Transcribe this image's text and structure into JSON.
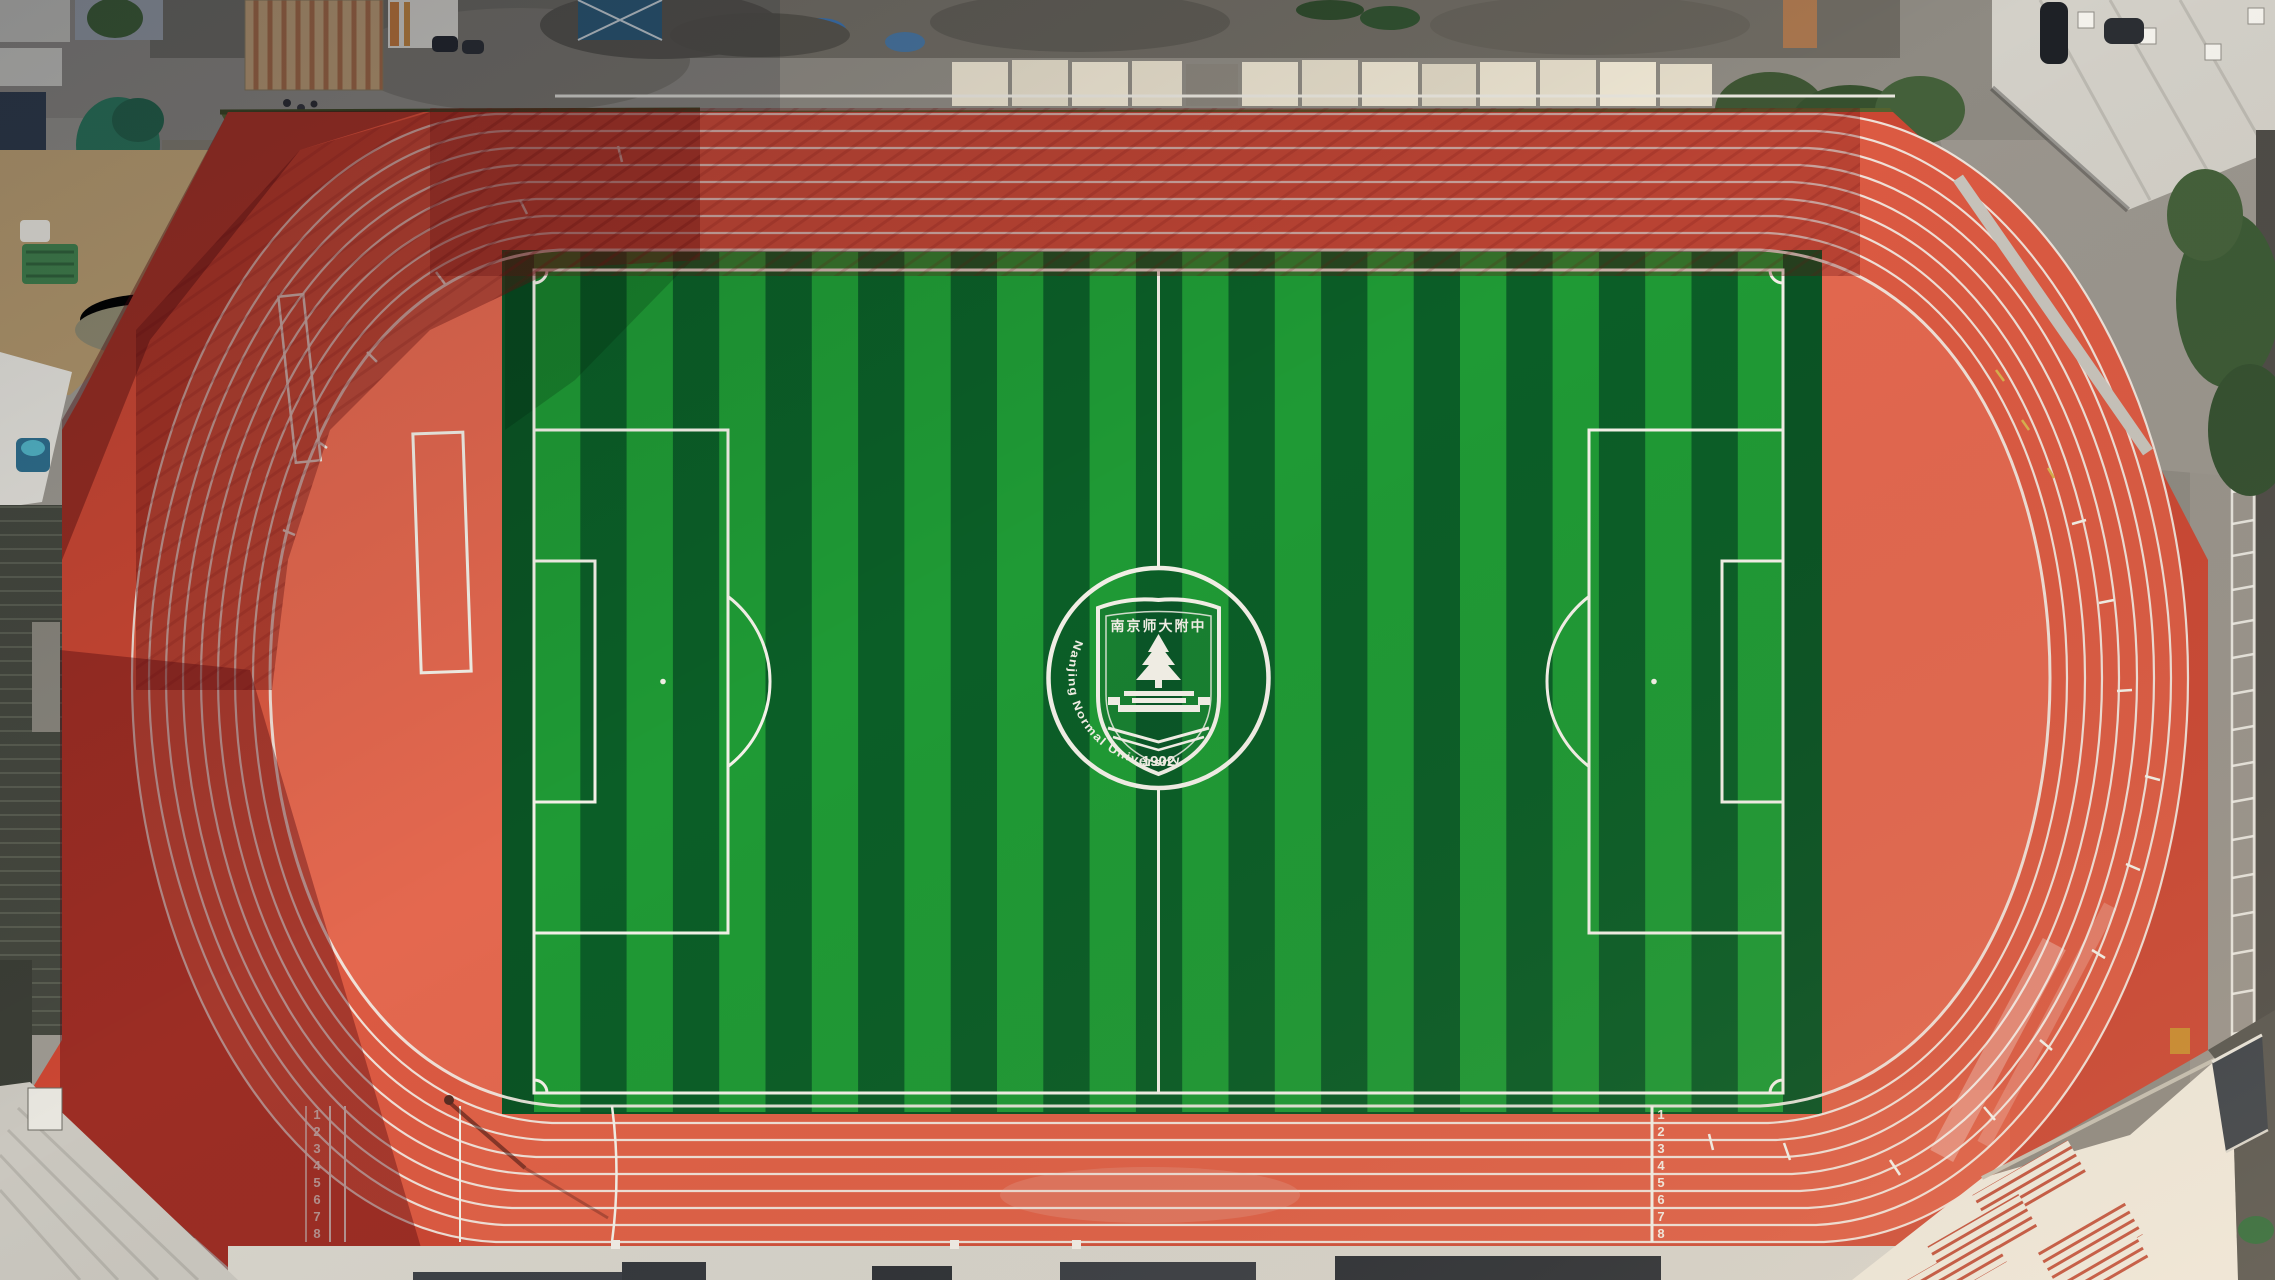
{
  "emblem": {
    "school_name_cn": "南京师大附中",
    "founding_year": "1902",
    "ring_text": "High School Affiliated To Nanjing Normal University"
  },
  "track": {
    "lane_count": 8,
    "lane_numbers": [
      "1",
      "2",
      "3",
      "4",
      "5",
      "6",
      "7",
      "8"
    ]
  },
  "colors": {
    "track_red": "#DC5A42",
    "outer_apron_red": "#CB4733",
    "infield_red": "#E4684F",
    "turf_light": "#1F9A35",
    "turf_dark": "#0B5E27",
    "marking_white": "#F4F1E8",
    "pavement_grey": "#D8D5CC",
    "road_grey": "#8E8A82",
    "roof_rust": "#A9764E",
    "excavator_yellow": "#C7A22B",
    "tarp_green": "#2C7A5C"
  }
}
